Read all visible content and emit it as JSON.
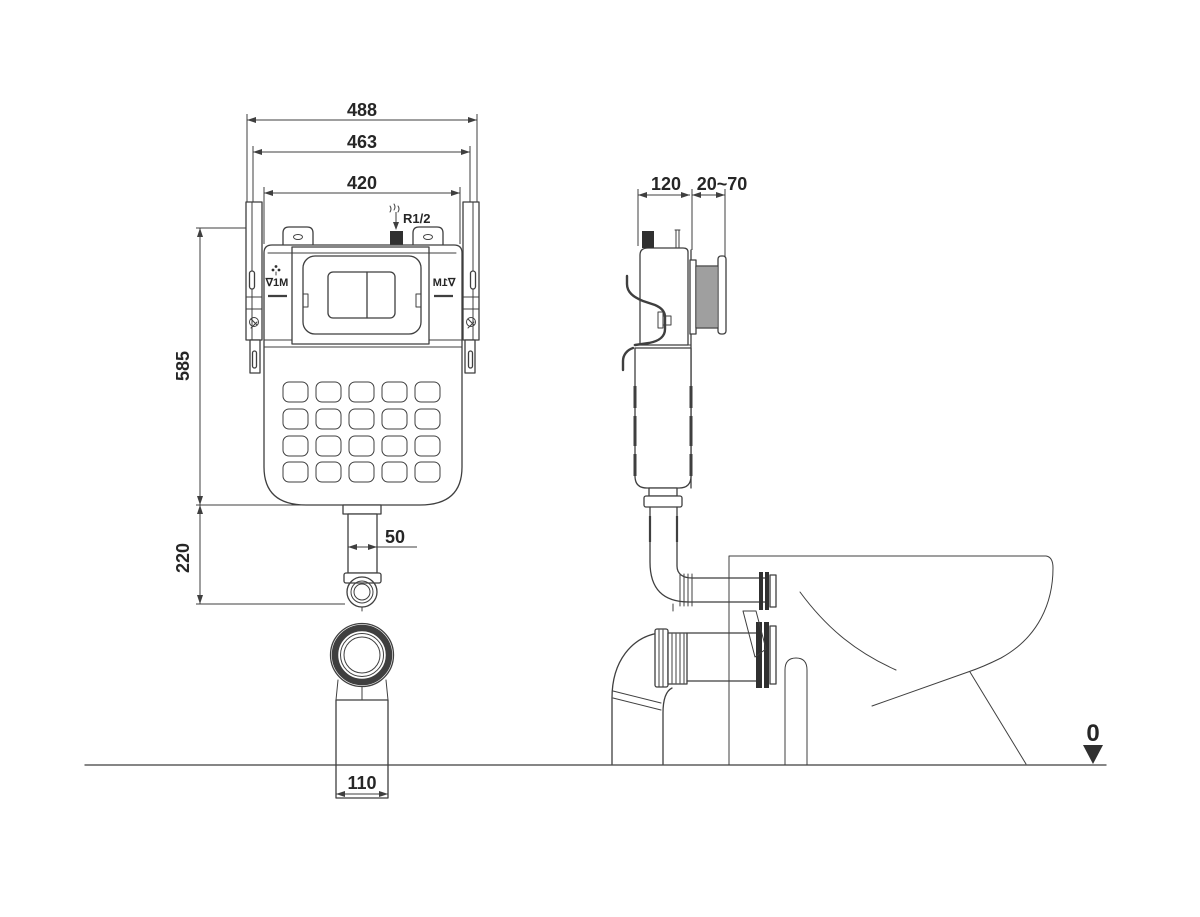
{
  "drawing_title": "Concealed cistern installation diagram",
  "front_view": {
    "dim_width_outer": "488",
    "dim_width_rails": "463",
    "dim_width_tank": "420",
    "dim_height_tank": "585",
    "dim_height_outlet": "220",
    "dim_pipe": "50",
    "dim_outlet_width": "110",
    "inlet_thread_label": "R1/2",
    "level_mark_left": "∇1M",
    "level_mark_right": "∇1M"
  },
  "side_view": {
    "dim_depth": "120",
    "dim_adjust_range": "20~70",
    "datum_level": "0"
  },
  "icons": {
    "inlet_flow": "water-flow-down-arrow",
    "level_mark": "dots-cluster",
    "datum": "filled-triangle-down"
  },
  "colors": {
    "line": "#3f3f3f",
    "text": "#262626",
    "fill_dark": "#303030",
    "background": "#ffffff"
  }
}
